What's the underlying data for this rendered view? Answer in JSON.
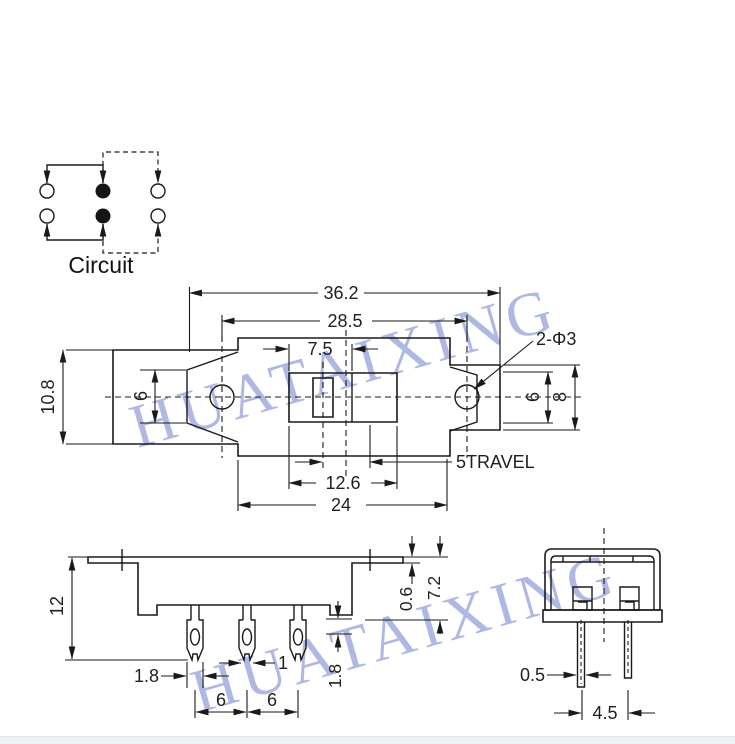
{
  "watermark": {
    "text": "HUATAIXING"
  },
  "circuit": {
    "label": "Circuit"
  },
  "top_view": {
    "dim_overall_width": "36.2",
    "dim_hole_spacing": "28.5",
    "dim_knob_slot": "7.5",
    "label_holes": "2-Φ3",
    "dim_left_end_height": "10.8",
    "dim_left_inner": "6",
    "dim_right_inner": "6",
    "dim_right_end_height": "8",
    "label_travel": "5TRAVEL",
    "dim_opening_width": "12.6",
    "dim_body_width": "24"
  },
  "front_view": {
    "dim_height": "12",
    "dim_terminal_tip_width": "1.8",
    "dim_terminal_neck_width": "1",
    "dim_pitch_left": "6",
    "dim_pitch_right": "6",
    "dim_step": "1.8",
    "dim_flange_thickness": "0.6",
    "dim_body_height": "7.2"
  },
  "side_view": {
    "dim_pin_thickness": "0.5",
    "dim_pin_spacing": "4.5"
  },
  "colors": {
    "line": "#1a1a1a",
    "text": "#1f1f1f",
    "watermark": "#9aa6dc",
    "background": "#ffffff",
    "footer_bar": "#eef1f3"
  }
}
